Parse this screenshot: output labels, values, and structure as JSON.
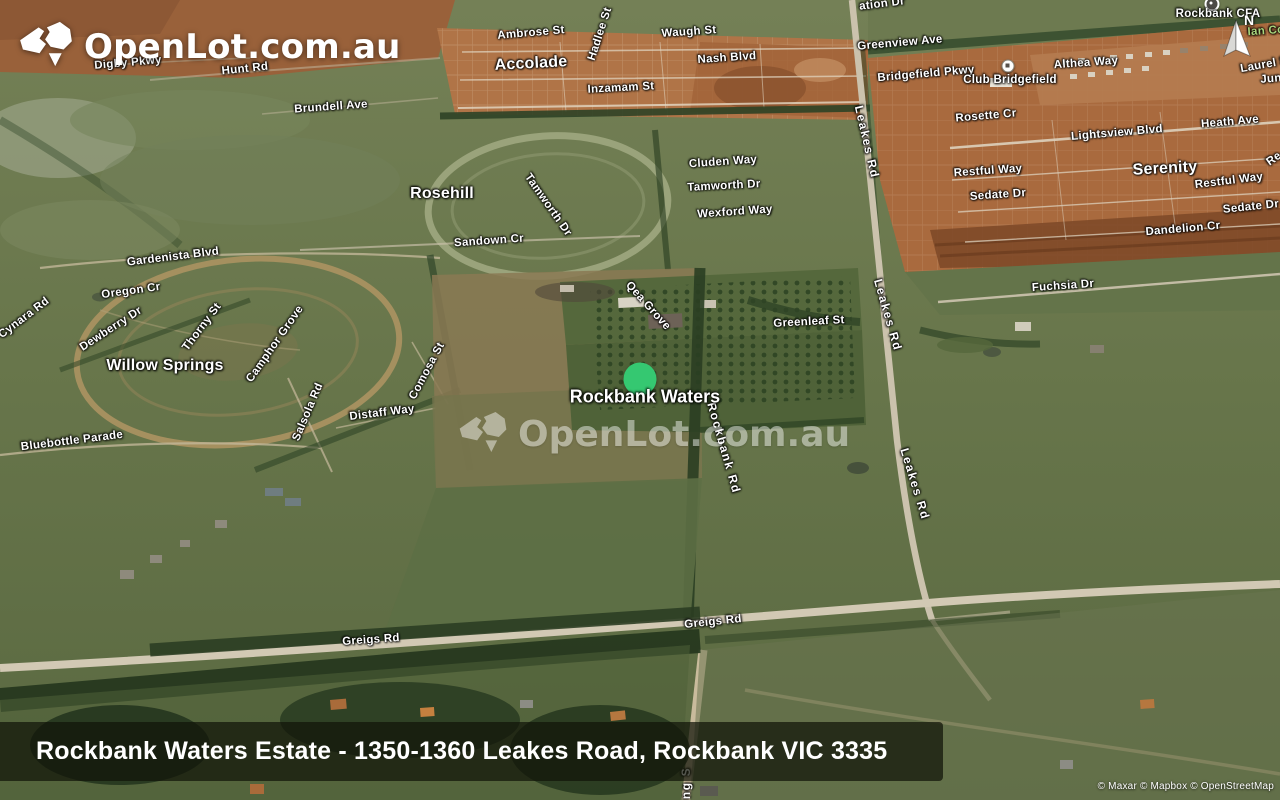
{
  "logo": {
    "text": "OpenLot.com.au"
  },
  "watermark": {
    "text": "OpenLot.com.au"
  },
  "compass": {
    "north_label": "N"
  },
  "marker": {
    "label": "Rockbank Waters",
    "x": 640,
    "y": 379,
    "color": "#35c871",
    "label_x": 645,
    "label_y": 397
  },
  "banner": {
    "text": "Rockbank Waters Estate - 1350-1360 Leakes Road, Rockbank VIC 3335"
  },
  "attribution": {
    "text": "© Maxar © Mapbox © OpenStreetMap"
  },
  "colors": {
    "marker_green": "#35c871",
    "banner_bg": "rgba(16,19,9,0.72)",
    "park_label": "#a8d57c"
  },
  "map_labels": [
    {
      "text": "Digby Pkwy",
      "x": 128,
      "y": 63,
      "rot": -5
    },
    {
      "text": "Hunt Rd",
      "x": 245,
      "y": 69,
      "rot": -6
    },
    {
      "text": "Brundell Ave",
      "x": 331,
      "y": 107,
      "rot": -4
    },
    {
      "text": "Ambrose St",
      "x": 531,
      "y": 33,
      "rot": -5
    },
    {
      "text": "Hadlee St",
      "x": 600,
      "y": 34,
      "rot": -72
    },
    {
      "text": "Waugh St",
      "x": 689,
      "y": 32,
      "rot": -4
    },
    {
      "text": "Nash Blvd",
      "x": 727,
      "y": 58,
      "rot": -4
    },
    {
      "text": "Inzamam St",
      "x": 621,
      "y": 88,
      "rot": -3
    },
    {
      "text": "Accolade",
      "x": 531,
      "y": 64,
      "rot": -3,
      "kind": "estate"
    },
    {
      "text": "ation Dr",
      "x": 882,
      "y": 4,
      "rot": -7
    },
    {
      "text": "Greenview Ave",
      "x": 900,
      "y": 43,
      "rot": -5
    },
    {
      "text": "Bridgefield Pkwy",
      "x": 926,
      "y": 74,
      "rot": -5
    },
    {
      "text": "Club Bridgefield",
      "x": 1010,
      "y": 80,
      "rot": 0,
      "icon": {
        "x": 1008,
        "y": 66,
        "variant": "light"
      }
    },
    {
      "text": "Althea Way",
      "x": 1086,
      "y": 63,
      "rot": -4
    },
    {
      "text": "Laurel S",
      "x": 1264,
      "y": 65,
      "rot": -10
    },
    {
      "text": "Jun",
      "x": 1271,
      "y": 79,
      "rot": -5
    },
    {
      "text": "Rockbank CFA",
      "x": 1218,
      "y": 14,
      "rot": 0,
      "icon": {
        "x": 1212,
        "y": 4,
        "variant": "dark"
      }
    },
    {
      "text": "Ian Co",
      "x": 1266,
      "y": 31,
      "rot": -4,
      "kind": "park"
    },
    {
      "text": "Rosette Cr",
      "x": 986,
      "y": 116,
      "rot": -5
    },
    {
      "text": "Heath Ave",
      "x": 1230,
      "y": 122,
      "rot": -5
    },
    {
      "text": "Lightsview Blvd",
      "x": 1117,
      "y": 133,
      "rot": -5
    },
    {
      "text": "Serenity",
      "x": 1165,
      "y": 169,
      "rot": -3,
      "kind": "estate"
    },
    {
      "text": "Restful Way",
      "x": 988,
      "y": 171,
      "rot": -4
    },
    {
      "text": "Restful Way",
      "x": 1229,
      "y": 181,
      "rot": -7
    },
    {
      "text": "Sedate Dr",
      "x": 998,
      "y": 195,
      "rot": -4
    },
    {
      "text": "Sedate Dr",
      "x": 1251,
      "y": 207,
      "rot": -6
    },
    {
      "text": "Dandelion Cr",
      "x": 1183,
      "y": 229,
      "rot": -5
    },
    {
      "text": "Re",
      "x": 1274,
      "y": 159,
      "rot": -35
    },
    {
      "text": "Leakes Rd",
      "x": 867,
      "y": 142,
      "rot": 77,
      "kind": "road"
    },
    {
      "text": "Leakes Rd",
      "x": 888,
      "y": 315,
      "rot": 74,
      "kind": "road"
    },
    {
      "text": "Leakes Rd",
      "x": 915,
      "y": 484,
      "rot": 73,
      "kind": "road"
    },
    {
      "text": "Rosehill",
      "x": 442,
      "y": 194,
      "rot": 0,
      "kind": "estate"
    },
    {
      "text": "Cluden Way",
      "x": 723,
      "y": 162,
      "rot": -4
    },
    {
      "text": "Tamworth Dr",
      "x": 724,
      "y": 186,
      "rot": -3
    },
    {
      "text": "Wexford Way",
      "x": 735,
      "y": 212,
      "rot": -4
    },
    {
      "text": "Sandown Cr",
      "x": 489,
      "y": 241,
      "rot": -4
    },
    {
      "text": "Tamworth Dr",
      "x": 548,
      "y": 205,
      "rot": 55
    },
    {
      "text": "Gardenista Blvd",
      "x": 173,
      "y": 257,
      "rot": -7
    },
    {
      "text": "Oregon Cr",
      "x": 131,
      "y": 291,
      "rot": -8
    },
    {
      "text": "Cynara Rd",
      "x": 24,
      "y": 318,
      "rot": -37
    },
    {
      "text": "Dewberry Dr",
      "x": 111,
      "y": 329,
      "rot": -33
    },
    {
      "text": "Thorny St",
      "x": 202,
      "y": 327,
      "rot": -53
    },
    {
      "text": "Willow Springs",
      "x": 165,
      "y": 366,
      "rot": 0,
      "kind": "estate"
    },
    {
      "text": "Camphor Grove",
      "x": 275,
      "y": 344,
      "rot": -55
    },
    {
      "text": "Comosa St",
      "x": 427,
      "y": 371,
      "rot": -62
    },
    {
      "text": "Salsola Rd",
      "x": 308,
      "y": 412,
      "rot": -67
    },
    {
      "text": "Distaff Way",
      "x": 382,
      "y": 413,
      "rot": -7
    },
    {
      "text": "Bluebottle Parade",
      "x": 72,
      "y": 441,
      "rot": -7
    },
    {
      "text": "Qea Grove",
      "x": 648,
      "y": 306,
      "rot": 48
    },
    {
      "text": "Greenleaf St",
      "x": 809,
      "y": 322,
      "rot": -3
    },
    {
      "text": "Fuchsia Dr",
      "x": 1063,
      "y": 286,
      "rot": -4
    },
    {
      "text": "Rockbank Rd",
      "x": 724,
      "y": 448,
      "rot": 74,
      "kind": "road"
    },
    {
      "text": "Greigs Rd",
      "x": 371,
      "y": 640,
      "rot": -4
    },
    {
      "text": "Greigs Rd",
      "x": 713,
      "y": 622,
      "rot": -6
    },
    {
      "text": "ng S",
      "x": 686,
      "y": 783,
      "rot": -90,
      "kind": "road"
    }
  ]
}
